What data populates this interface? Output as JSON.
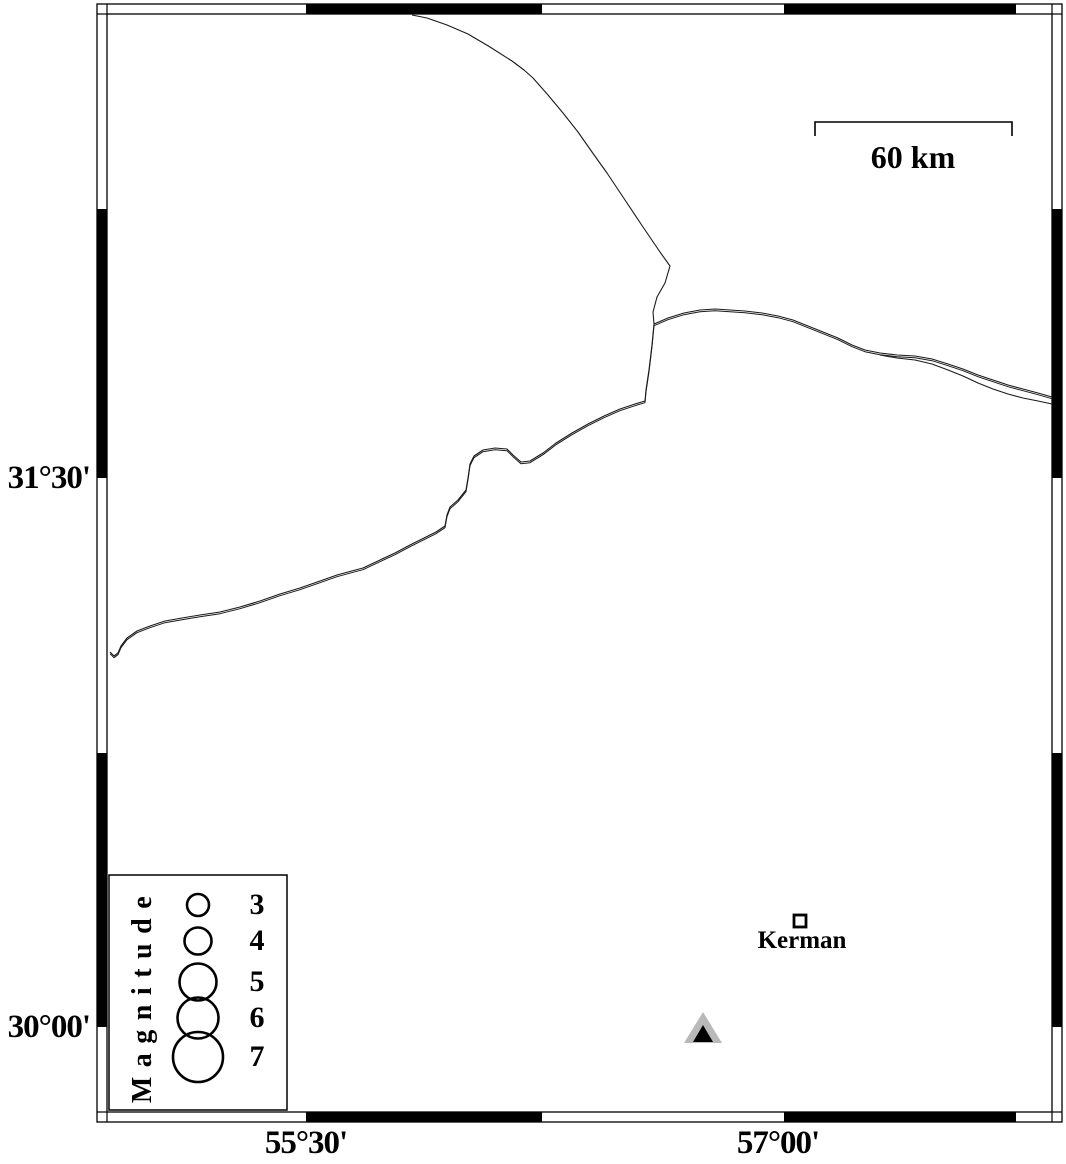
{
  "page": {
    "width": 1066,
    "height": 1160,
    "background": "#ffffff"
  },
  "map": {
    "frame": {
      "outer": [
        97,
        4,
        1062,
        1122
      ],
      "inner": [
        107,
        14,
        1052,
        1112
      ],
      "black_segments": {
        "top": [
          [
            306,
            542
          ],
          [
            784,
            1016
          ]
        ],
        "bottom": [
          [
            306,
            542
          ],
          [
            784,
            1016
          ]
        ],
        "left": [
          [
            209,
            478
          ],
          [
            753,
            1027
          ]
        ],
        "right": [
          [
            209,
            478
          ],
          [
            753,
            1027
          ]
        ]
      }
    },
    "axis": {
      "left": [
        {
          "label": "31°30'",
          "y": 478
        },
        {
          "label": "30°00'",
          "y": 1027
        }
      ],
      "bottom": [
        {
          "label": "55°30'",
          "x": 306
        },
        {
          "label": "57°00'",
          "x": 778
        }
      ]
    },
    "scalebar": {
      "label": "60 km",
      "x1": 815,
      "x2": 1012,
      "y": 122,
      "tick_drop": 14
    },
    "city": {
      "name": "Kerman",
      "x": 800,
      "y": 921,
      "size": 12
    },
    "triangle": {
      "x": 703,
      "y_base": 1043,
      "w_outer": 38,
      "h_outer": 31,
      "w_inner": 20,
      "h_inner": 17,
      "outer_color": "#b9b9b9",
      "inner_color": "#000000"
    },
    "legend": {
      "title": "Magnitude",
      "box": [
        109,
        875,
        178,
        235
      ],
      "circle_cx": 198,
      "label_cx": 257,
      "title_cx": 143,
      "title_cy": 995,
      "entries": [
        {
          "label": "3",
          "cy": 905,
          "r": 11
        },
        {
          "label": "4",
          "cy": 941,
          "r": 13.5
        },
        {
          "label": "5",
          "cy": 982,
          "r": 18.5
        },
        {
          "label": "6",
          "cy": 1018,
          "r": 20.5
        },
        {
          "label": "7",
          "cy": 1057,
          "r": 25
        }
      ]
    },
    "line_color": "#1a1a1a",
    "faults": [
      {
        "name": "fault-line-north",
        "double": false,
        "points": [
          [
            412,
            15
          ],
          [
            427,
            18
          ],
          [
            447,
            25
          ],
          [
            468,
            34
          ],
          [
            490,
            47
          ],
          [
            512,
            61
          ],
          [
            524,
            70
          ],
          [
            533,
            78
          ],
          [
            548,
            95
          ],
          [
            563,
            113
          ],
          [
            578,
            132
          ],
          [
            592,
            152
          ],
          [
            607,
            173
          ],
          [
            623,
            197
          ],
          [
            643,
            227
          ],
          [
            660,
            252
          ],
          [
            670,
            266
          ],
          [
            665,
            283
          ],
          [
            657,
            297
          ],
          [
            653,
            312
          ],
          [
            654,
            324
          ]
        ]
      },
      {
        "name": "fault-line-southwest",
        "double": true,
        "points": [
          [
            654,
            324
          ],
          [
            652,
            345
          ],
          [
            649,
            370
          ],
          [
            646,
            390
          ],
          [
            645,
            401
          ],
          [
            635,
            404
          ],
          [
            620,
            409
          ],
          [
            604,
            416
          ],
          [
            588,
            424
          ],
          [
            572,
            433
          ],
          [
            556,
            443
          ],
          [
            543,
            453
          ],
          [
            530,
            461
          ],
          [
            521,
            462
          ],
          [
            513,
            455
          ],
          [
            507,
            449
          ],
          [
            495,
            448
          ],
          [
            483,
            450
          ],
          [
            474,
            456
          ],
          [
            470,
            464
          ],
          [
            468,
            478
          ],
          [
            466,
            490
          ],
          [
            458,
            500
          ],
          [
            450,
            507
          ],
          [
            447,
            515
          ],
          [
            445,
            526
          ],
          [
            436,
            532
          ],
          [
            424,
            538
          ],
          [
            410,
            545
          ],
          [
            395,
            553
          ],
          [
            380,
            560
          ],
          [
            363,
            568
          ],
          [
            348,
            572
          ],
          [
            337,
            575
          ],
          [
            320,
            581
          ],
          [
            300,
            588
          ],
          [
            280,
            594
          ],
          [
            260,
            601
          ],
          [
            240,
            607
          ],
          [
            220,
            612
          ],
          [
            200,
            615
          ],
          [
            182,
            618
          ],
          [
            165,
            621
          ],
          [
            150,
            626
          ],
          [
            137,
            631
          ],
          [
            127,
            638
          ],
          [
            121,
            646
          ],
          [
            118,
            653
          ],
          [
            114,
            656
          ],
          [
            110,
            652
          ]
        ]
      },
      {
        "name": "fault-line-east",
        "double": true,
        "points": [
          [
            654,
            324
          ],
          [
            668,
            318
          ],
          [
            684,
            313
          ],
          [
            700,
            310
          ],
          [
            715,
            309
          ],
          [
            730,
            310
          ],
          [
            745,
            311
          ],
          [
            762,
            313
          ],
          [
            778,
            316
          ],
          [
            793,
            320
          ],
          [
            808,
            326
          ],
          [
            823,
            332
          ],
          [
            838,
            338
          ],
          [
            852,
            345
          ],
          [
            865,
            350
          ],
          [
            880,
            353
          ],
          [
            897,
            355
          ],
          [
            915,
            356
          ],
          [
            932,
            359
          ],
          [
            948,
            364
          ],
          [
            963,
            369
          ],
          [
            978,
            375
          ],
          [
            993,
            380
          ],
          [
            1008,
            385
          ],
          [
            1023,
            389
          ],
          [
            1038,
            393
          ],
          [
            1052,
            397
          ]
        ]
      },
      {
        "name": "fault-line-east-branch",
        "double": false,
        "points": [
          [
            880,
            355
          ],
          [
            897,
            358
          ],
          [
            915,
            360
          ],
          [
            932,
            364
          ],
          [
            948,
            370
          ],
          [
            963,
            376
          ],
          [
            978,
            383
          ],
          [
            993,
            389
          ],
          [
            1008,
            394
          ],
          [
            1023,
            398
          ],
          [
            1038,
            401
          ],
          [
            1052,
            404
          ]
        ]
      }
    ]
  }
}
